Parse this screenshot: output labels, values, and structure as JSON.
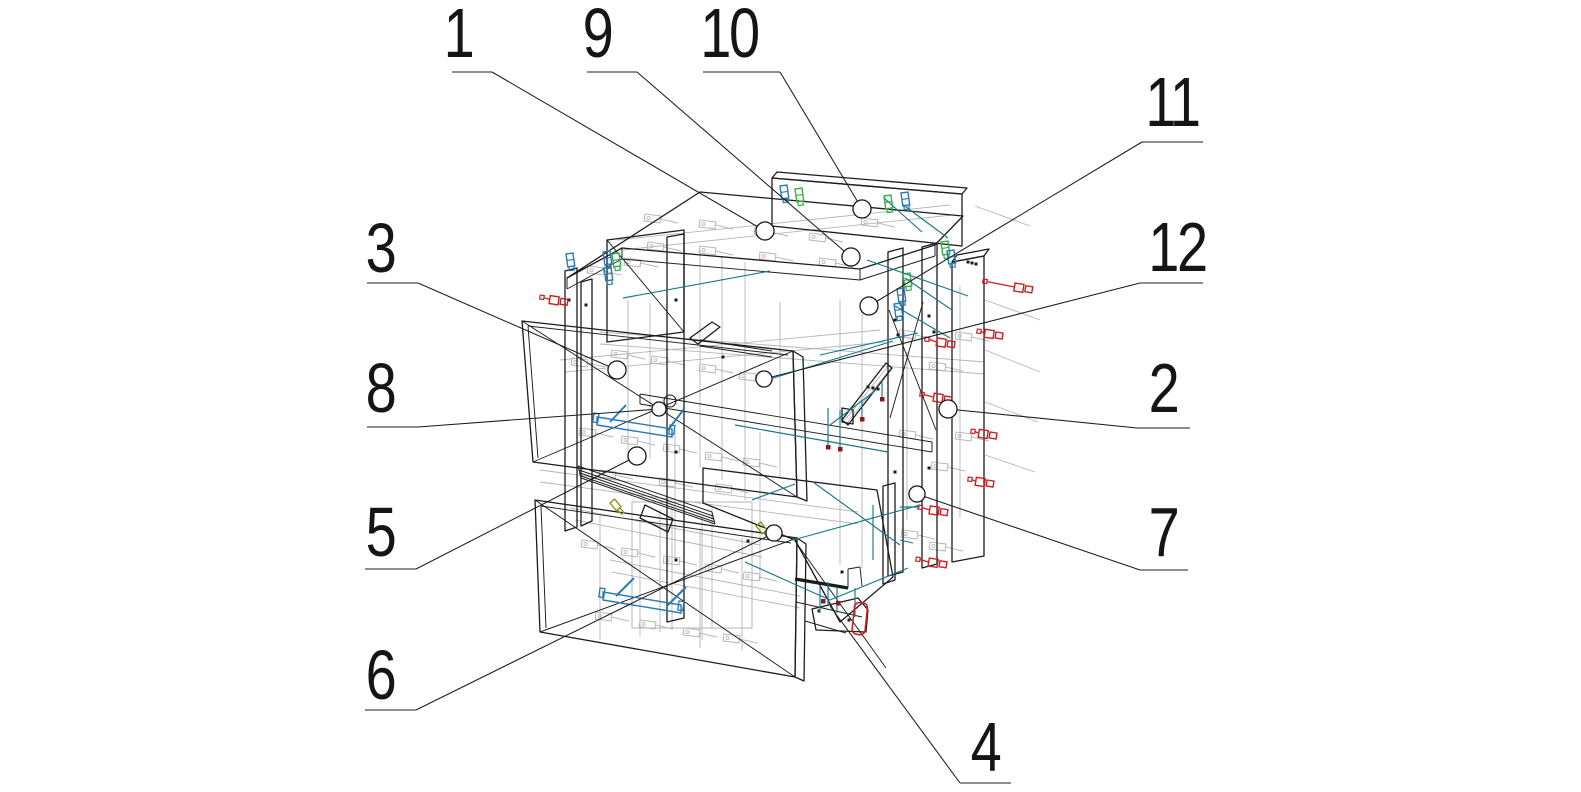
{
  "drawing": {
    "type": "exploded-assembly-wireframe",
    "subject": "corner cabinet with two drawers, hardware and fasteners",
    "background": "#ffffff",
    "width": 1581,
    "height": 792
  },
  "colors": {
    "line": "#1c1c1c",
    "gray": "#b5b5b5",
    "red": "#cc2020",
    "darkred": "#8b1a1a",
    "blue": "#2a7ab8",
    "green": "#33b04a",
    "teal": "#17798b",
    "olive": "#8f9420",
    "text": "#151515",
    "white": "#ffffff"
  },
  "callouts": [
    {
      "n": "1",
      "tx": 458,
      "ty": 57,
      "h": [
        452,
        72,
        492,
        72
      ],
      "d": [
        492,
        72,
        765,
        231
      ],
      "c": [
        765,
        231,
        9
      ]
    },
    {
      "n": "9",
      "tx": 597,
      "ty": 57,
      "h": [
        587,
        72,
        637,
        72
      ],
      "d": [
        637,
        72,
        851,
        257
      ],
      "c": [
        851,
        257,
        9
      ]
    },
    {
      "n": "10",
      "tx": 729,
      "ty": 57,
      "h": [
        703,
        72,
        780,
        72
      ],
      "d": [
        780,
        72,
        862,
        209
      ],
      "c": [
        862,
        209,
        9
      ]
    },
    {
      "n": "11",
      "tx": 1172,
      "ty": 126,
      "h": [
        1142,
        142,
        1203,
        142
      ],
      "d": [
        1142,
        142,
        869,
        306
      ],
      "c": [
        869,
        306,
        9
      ]
    },
    {
      "n": "12",
      "tx": 1177,
      "ty": 271,
      "h": [
        1140,
        283,
        1203,
        283
      ],
      "d": [
        1140,
        283,
        764,
        379
      ],
      "c": [
        764,
        379,
        8
      ]
    },
    {
      "n": "2",
      "tx": 1163,
      "ty": 412,
      "h": [
        1137,
        428,
        1190,
        428
      ],
      "d": [
        1137,
        428,
        948,
        409
      ],
      "c": [
        948,
        409,
        9
      ]
    },
    {
      "n": "7",
      "tx": 1163,
      "ty": 556,
      "h": [
        1140,
        570,
        1188,
        570
      ],
      "d": [
        1140,
        570,
        917,
        494
      ],
      "c": [
        917,
        494,
        8
      ]
    },
    {
      "n": "3",
      "tx": 380,
      "ty": 272,
      "h": [
        367,
        283,
        418,
        283
      ],
      "d": [
        418,
        283,
        617,
        370
      ],
      "c": [
        617,
        370,
        9
      ]
    },
    {
      "n": "8",
      "tx": 380,
      "ty": 412,
      "h": [
        367,
        427,
        418,
        427
      ],
      "d": [
        418,
        427,
        659,
        409
      ],
      "c": [
        659,
        409,
        7
      ]
    },
    {
      "n": "5",
      "tx": 380,
      "ty": 556,
      "h": [
        365,
        569,
        416,
        569
      ],
      "d": [
        416,
        569,
        637,
        456
      ],
      "c": [
        637,
        456,
        9
      ]
    },
    {
      "n": "6",
      "tx": 380,
      "ty": 699,
      "h": [
        365,
        710,
        416,
        710
      ],
      "d": [
        416,
        710,
        774,
        533
      ],
      "c": [
        774,
        533,
        8
      ]
    },
    {
      "n": "4",
      "tx": 985,
      "ty": 771,
      "h": [
        960,
        783,
        1011,
        783
      ],
      "d": [
        960,
        783,
        830,
        606
      ],
      "c": null
    }
  ],
  "panels": [
    {
      "name": "top-panel",
      "pts": "567,278 700,192 963,216 935,245 860,269 622,248"
    },
    {
      "name": "back-top-rail",
      "pts": "772,178 962,194 962,246 772,226"
    },
    {
      "name": "back-top-rail-top-face",
      "pts": "772,178 777,172 967,188 962,194"
    },
    {
      "name": "left-back-panel",
      "pts": "607,240 684,230 684,332 607,342"
    },
    {
      "name": "left-side-strip-1",
      "pts": "565,271 577,268 577,527 565,531"
    },
    {
      "name": "left-side-strip-2",
      "pts": "581,282 592,279 592,521 581,526"
    },
    {
      "name": "center-back-panel",
      "pts": "667,237 684,234 684,618 667,622"
    },
    {
      "name": "right-side-strip-1",
      "pts": "888,252 903,248 903,572 888,576"
    },
    {
      "name": "right-side-strip-2",
      "pts": "922,247 937,243 937,564 922,568"
    },
    {
      "name": "right-side-panel",
      "pts": "952,262 984,256 984,556 952,562"
    },
    {
      "name": "right-side-panel-top-face",
      "pts": "952,262 957,255 989,249 984,256"
    },
    {
      "name": "upper-drawer-front",
      "pts": "522,321 793,351 797,497 533,462"
    },
    {
      "name": "upper-drawer-front-edge",
      "pts": "793,351 803,357 807,501 797,497"
    },
    {
      "name": "lower-drawer-front",
      "pts": "535,500 797,538 795,677 540,632"
    },
    {
      "name": "lower-drawer-front-edge",
      "pts": "797,538 806,544 804,681 795,677"
    },
    {
      "name": "bottom-slab",
      "pts": "703,468 877,490 893,577 840,622 795,540 703,503"
    },
    {
      "name": "bottom-back-rail",
      "pts": "883,486 895,483 895,580 883,584"
    },
    {
      "name": "corner-wedge",
      "pts": "690,338 712,322 720,327 698,344"
    },
    {
      "name": "slide-wedge",
      "pts": "645,505 673,519 668,532 640,518"
    },
    {
      "name": "diagonal-brace",
      "pts": "842,420 886,363 892,368 848,425"
    },
    {
      "name": "brace-foot-block",
      "pts": "842,408 853,410 853,424 842,422"
    },
    {
      "name": "foot-bracket",
      "pts": "812,609 858,598 868,610 866,632 816,630"
    }
  ],
  "black_lines": [
    [
      567,
      278,
      567,
      289
    ],
    [
      567,
      289,
      622,
      259
    ],
    [
      622,
      248,
      622,
      259
    ],
    [
      622,
      259,
      860,
      280
    ],
    [
      860,
      269,
      860,
      280
    ],
    [
      860,
      280,
      935,
      256
    ],
    [
      935,
      245,
      935,
      256
    ],
    [
      640,
      394,
      932,
      442
    ],
    [
      640,
      404,
      932,
      452
    ],
    [
      640,
      394,
      640,
      404
    ],
    [
      932,
      442,
      932,
      452
    ],
    [
      522,
      321,
      797,
      497
    ],
    [
      533,
      462,
      793,
      351
    ],
    [
      535,
      500,
      795,
      677
    ],
    [
      540,
      632,
      797,
      538
    ],
    [
      889,
      310,
      936,
      430
    ],
    [
      923,
      302,
      890,
      418
    ],
    [
      607,
      240,
      684,
      332
    ],
    [
      795,
      541,
      886,
      668
    ],
    [
      528,
      326,
      788,
      355
    ],
    [
      528,
      326,
      538,
      458
    ],
    [
      541,
      506,
      791,
      543
    ],
    [
      541,
      506,
      546,
      628
    ],
    [
      700,
      340,
      772,
      351
    ],
    [
      700,
      346,
      772,
      357
    ],
    [
      848,
      588,
      848,
      569
    ],
    [
      848,
      569,
      860,
      567
    ],
    [
      860,
      567,
      862,
      586
    ],
    [
      796,
      602,
      862,
      617
    ],
    [
      805,
      621,
      846,
      633
    ],
    [
      578,
      466,
      712,
      512
    ],
    [
      581,
      478,
      715,
      524
    ],
    [
      578,
      466,
      581,
      478
    ],
    [
      712,
      512,
      715,
      524
    ],
    [
      579,
      470,
      713,
      516
    ],
    [
      580,
      473,
      714,
      519
    ],
    [
      581,
      476,
      715,
      522
    ]
  ],
  "thick_lines": [
    [
      795,
      579,
      848,
      588
    ]
  ],
  "black_dots": [
    [
      676,
      300
    ],
    [
      676,
      452
    ],
    [
      676,
      560
    ],
    [
      569,
      300
    ],
    [
      586,
      305
    ],
    [
      895,
      320
    ],
    [
      895,
      472
    ],
    [
      929,
      316
    ],
    [
      929,
      468
    ],
    [
      723,
      357
    ],
    [
      748,
      541
    ],
    [
      868,
      387
    ],
    [
      873,
      388
    ],
    [
      878,
      389
    ],
    [
      968,
      262
    ],
    [
      972,
      263
    ],
    [
      976,
      264
    ],
    [
      898,
      335
    ],
    [
      934,
      332
    ],
    [
      819,
      611
    ],
    [
      849,
      620
    ],
    [
      842,
      572
    ]
  ],
  "gray_lines": [
    [
      540,
      470,
      858,
      512
    ],
    [
      540,
      482,
      858,
      524
    ],
    [
      600,
      332,
      985,
      362
    ],
    [
      600,
      344,
      985,
      374
    ],
    [
      617,
      240,
      950,
      205
    ],
    [
      622,
      250,
      952,
      215
    ],
    [
      700,
      250,
      700,
      468
    ],
    [
      722,
      256,
      722,
      480
    ],
    [
      745,
      262,
      745,
      500
    ],
    [
      840,
      300,
      840,
      565
    ],
    [
      862,
      306,
      862,
      568
    ],
    [
      907,
      352,
      907,
      520
    ],
    [
      960,
      286,
      960,
      518
    ],
    [
      628,
      300,
      628,
      452
    ],
    [
      650,
      303,
      650,
      458
    ],
    [
      675,
      430,
      675,
      558
    ],
    [
      760,
      432,
      760,
      580
    ],
    [
      780,
      302,
      780,
      478
    ],
    [
      985,
      300,
      1040,
      320
    ],
    [
      985,
      350,
      1040,
      372
    ],
    [
      985,
      402,
      1038,
      422
    ],
    [
      985,
      455,
      1035,
      472
    ],
    [
      975,
      206,
      1030,
      226
    ],
    [
      600,
      516,
      600,
      640
    ],
    [
      640,
      520,
      640,
      636
    ],
    [
      700,
      530,
      700,
      648
    ],
    [
      742,
      538,
      742,
      650
    ],
    [
      570,
      508,
      760,
      545
    ],
    [
      575,
      520,
      762,
      557
    ],
    [
      660,
      510,
      660,
      632
    ],
    [
      702,
      516,
      702,
      640
    ],
    [
      845,
      420,
      889,
      365
    ],
    [
      847,
      423,
      891,
      368
    ],
    [
      560,
      360,
      880,
      330
    ],
    [
      565,
      372,
      885,
      342
    ],
    [
      610,
      560,
      800,
      596
    ],
    [
      612,
      572,
      800,
      608
    ]
  ],
  "gray_boxes": [
    [
      632,
      502,
      120,
      126
    ]
  ],
  "gray_fittings": [
    [
      572,
      358
    ],
    [
      612,
      350
    ],
    [
      652,
      356
    ],
    [
      700,
      364
    ],
    [
      740,
      372
    ],
    [
      580,
      428
    ],
    [
      622,
      436
    ],
    [
      664,
      444
    ],
    [
      706,
      452
    ],
    [
      744,
      458
    ],
    [
      600,
      470
    ],
    [
      660,
      478
    ],
    [
      716,
      484
    ],
    [
      582,
      540
    ],
    [
      622,
      548
    ],
    [
      664,
      556
    ],
    [
      706,
      564
    ],
    [
      744,
      572
    ],
    [
      596,
      612
    ],
    [
      640,
      620
    ],
    [
      684,
      628
    ],
    [
      724,
      634
    ],
    [
      900,
      330
    ],
    [
      930,
      362
    ],
    [
      956,
      332
    ],
    [
      900,
      430
    ],
    [
      932,
      462
    ],
    [
      956,
      432
    ],
    [
      902,
      530
    ],
    [
      930,
      542
    ],
    [
      645,
      214
    ],
    [
      700,
      220
    ],
    [
      755,
      227
    ],
    [
      810,
      233
    ],
    [
      625,
      258
    ],
    [
      588,
      266
    ],
    [
      648,
      242
    ],
    [
      700,
      246
    ],
    [
      760,
      252
    ],
    [
      820,
      258
    ],
    [
      862,
      218
    ]
  ],
  "teal_lines": [
    [
      623,
      298,
      770,
      271
    ],
    [
      867,
      260,
      968,
      296
    ],
    [
      902,
      204,
      948,
      238
    ],
    [
      884,
      198,
      922,
      232
    ],
    [
      905,
      278,
      952,
      310
    ],
    [
      895,
      306,
      950,
      338
    ],
    [
      767,
      380,
      893,
      341
    ],
    [
      820,
      355,
      918,
      333
    ],
    [
      735,
      425,
      888,
      452
    ],
    [
      793,
      540,
      920,
      505
    ],
    [
      813,
      482,
      900,
      545
    ],
    [
      745,
      562,
      830,
      600
    ],
    [
      830,
      600,
      908,
      568
    ],
    [
      752,
      500,
      795,
      484
    ],
    [
      828,
      408,
      828,
      446
    ],
    [
      840,
      410,
      840,
      448
    ],
    [
      862,
      400,
      862,
      418
    ],
    [
      882,
      380,
      882,
      398
    ],
    [
      820,
      585,
      820,
      612
    ],
    [
      828,
      582,
      828,
      605
    ],
    [
      837,
      587,
      837,
      613
    ],
    [
      855,
      588,
      855,
      617
    ],
    [
      873,
      505,
      873,
      560
    ],
    [
      900,
      507,
      920,
      507
    ],
    [
      900,
      540,
      913,
      543
    ],
    [
      830,
      425,
      875,
      391
    ]
  ],
  "red_squares": [
    [
      828,
      447
    ],
    [
      840,
      449
    ],
    [
      862,
      419
    ],
    [
      882,
      399
    ],
    [
      823,
      601
    ],
    [
      838,
      603
    ]
  ],
  "red_strap": {
    "x": 855,
    "y": 602,
    "w": 13,
    "h": 32,
    "rx": 5,
    "rot": 6
  },
  "screws_red": [
    [
      983,
      281,
      50
    ],
    [
      925,
      339,
      30
    ],
    [
      977,
      331,
      26
    ],
    [
      920,
      394,
      32
    ],
    [
      971,
      431,
      26
    ],
    [
      968,
      479,
      26
    ],
    [
      918,
      507,
      30
    ],
    [
      916,
      559,
      31
    ],
    [
      540,
      297,
      28
    ]
  ],
  "clips_green": [
    [
      795,
      189
    ],
    [
      884,
      196
    ],
    [
      941,
      242
    ],
    [
      903,
      274
    ],
    [
      612,
      254
    ]
  ],
  "clips_blue": [
    [
      780,
      186
    ],
    [
      901,
      193
    ],
    [
      947,
      251
    ],
    [
      897,
      289
    ],
    [
      894,
      304
    ],
    [
      603,
      252
    ],
    [
      604,
      268
    ],
    [
      566,
      254
    ]
  ],
  "handles": [
    {
      "bar": "597,417 672,429 672,437 597,425",
      "struts": [
        [
          610,
          422,
          626,
          405
        ],
        [
          668,
          430,
          684,
          409
        ]
      ],
      "caps": [
        [
          594,
          413
        ],
        [
          670,
          425
        ]
      ]
    },
    {
      "bar": "603,592 681,605 681,613 603,600",
      "struts": [
        [
          616,
          596,
          634,
          578
        ],
        [
          668,
          605,
          686,
          587
        ]
      ],
      "caps": [
        [
          600,
          588
        ],
        [
          679,
          601
        ]
      ]
    }
  ],
  "olive_screws": [
    [
      610,
      503
    ],
    [
      756,
      526
    ]
  ],
  "extra_circles": [
    [
      670,
      401,
      6
    ]
  ]
}
